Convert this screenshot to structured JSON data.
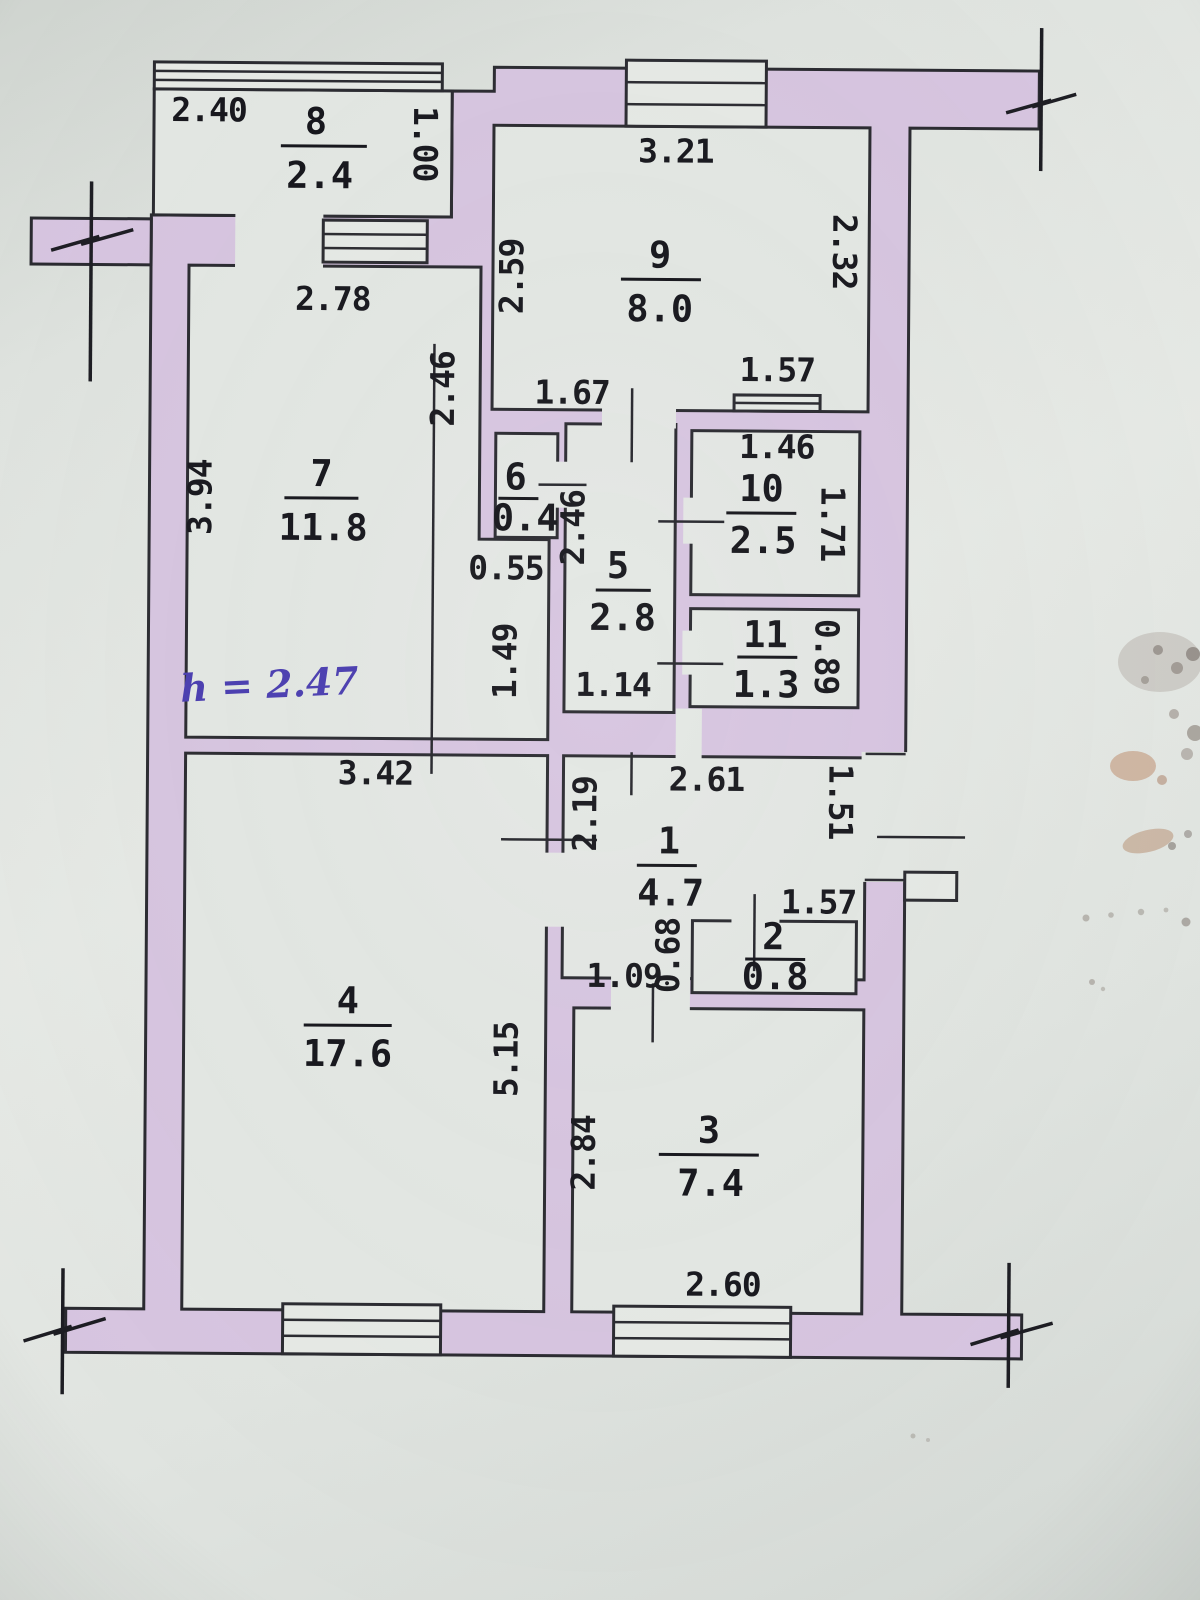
{
  "document": {
    "kind": "scanned apartment floor plan",
    "height_note": "h = 2.47"
  },
  "plan": {
    "rooms": [
      {
        "id": "room-8",
        "number": "8",
        "area": "2.4"
      },
      {
        "id": "room-9",
        "number": "9",
        "area": "8.0"
      },
      {
        "id": "room-7",
        "number": "7",
        "area": "11.8"
      },
      {
        "id": "room-6",
        "number": "6",
        "area": "0.4"
      },
      {
        "id": "room-5",
        "number": "5",
        "area": "2.8"
      },
      {
        "id": "room-10",
        "number": "10",
        "area": "2.5"
      },
      {
        "id": "room-11",
        "number": "11",
        "area": "1.3"
      },
      {
        "id": "room-1",
        "number": "1",
        "area": "4.7"
      },
      {
        "id": "room-2",
        "number": "2",
        "area": "0.8"
      },
      {
        "id": "room-4",
        "number": "4",
        "area": "17.6"
      },
      {
        "id": "room-3",
        "number": "3",
        "area": "7.4"
      }
    ],
    "dimensions": {
      "balcony_top": "2.40",
      "balcony_depth": "1.00",
      "room7_top": "2.78",
      "room9_top": "3.21",
      "room9_left": "2.59",
      "room9_right": "2.32",
      "room10_opening": "1.57",
      "room10_top": "1.46",
      "room9_bottom_left": "1.67",
      "room7_right_upper": "2.46",
      "room7_left": "3.94",
      "corridor_left": "2.46",
      "step_width": "0.55",
      "room10_right": "1.71",
      "corridor_left_lower": "1.49",
      "corridor_bottom": "1.14",
      "room11_right": "0.89",
      "room4_top": "3.42",
      "hall_top": "2.61",
      "hall_left": "2.19",
      "hall_right": "1.51",
      "room2_top": "1.57",
      "room2_left": "0.68",
      "room3_door": "1.09",
      "room4_right": "5.15",
      "room3_left": "2.84",
      "room3_bottom": "2.60"
    },
    "annotations": {
      "ceiling_height": "h = 2.47"
    },
    "colors": {
      "wall_fill": "#d7c5e0",
      "handwriting_ink": "#4a3db0",
      "line": "#2a2a30"
    }
  }
}
